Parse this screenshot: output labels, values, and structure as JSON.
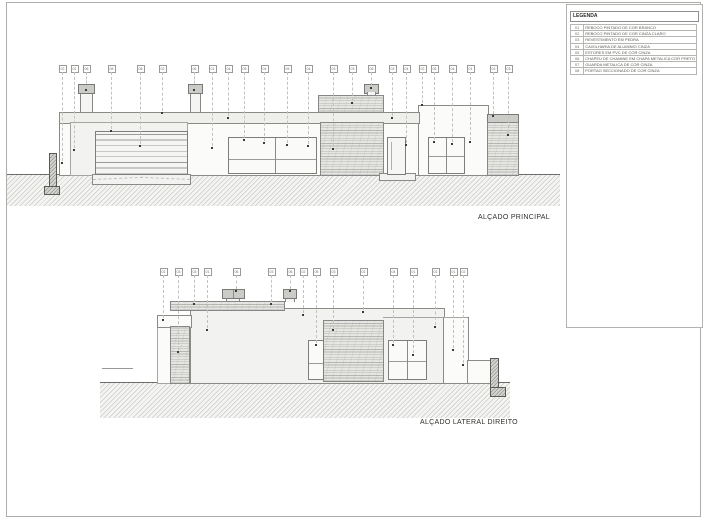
{
  "sheet": {
    "legend": {
      "title": "LEGENDA",
      "items": [
        {
          "code": "01",
          "desc": "REBOCO PINTADO DE COR BRANCO"
        },
        {
          "code": "02",
          "desc": "REBOCO PINTADO DE COR CINZA CLARO"
        },
        {
          "code": "03",
          "desc": "REVESTIMENTO EM PEDRA"
        },
        {
          "code": "04",
          "desc": "CAIXILHARIA DE ALUMINIO CINZA"
        },
        {
          "code": "05",
          "desc": "ESTORES EM PVC DE COR CINZA"
        },
        {
          "code": "06",
          "desc": "CHAPEU DE CHAMINE EM CHAPA METALICA COR PRETO"
        },
        {
          "code": "07",
          "desc": "GUARDA METALICA DE COR CINZA"
        },
        {
          "code": "08",
          "desc": "PORTAO SECCIONADO DE COR CINZA"
        }
      ]
    },
    "colors": {
      "line": "#8a8a87",
      "ground_hatch": "#c9c9c6",
      "stone": "#e6e6e3",
      "wall_light": "#f2f2f0",
      "cap_gray": "#cbcbc8"
    },
    "elevations": {
      "top": {
        "label": "ALÇADO PRINCIPAL",
        "callout_box_y": 65,
        "callouts": [
          {
            "n": "02",
            "x": 62,
            "y2": 163
          },
          {
            "n": "01",
            "x": 74,
            "y2": 150
          },
          {
            "n": "06",
            "x": 86,
            "y2": 90
          },
          {
            "n": "08",
            "x": 111,
            "y2": 131
          },
          {
            "n": "08",
            "x": 140,
            "y2": 146
          },
          {
            "n": "02",
            "x": 162,
            "y2": 113
          },
          {
            "n": "06",
            "x": 194,
            "y2": 90
          },
          {
            "n": "01",
            "x": 212,
            "y2": 148
          },
          {
            "n": "04",
            "x": 228,
            "y2": 118
          },
          {
            "n": "05",
            "x": 244,
            "y2": 140
          },
          {
            "n": "04",
            "x": 264,
            "y2": 143
          },
          {
            "n": "05",
            "x": 287,
            "y2": 145
          },
          {
            "n": "04",
            "x": 308,
            "y2": 146
          },
          {
            "n": "03",
            "x": 333,
            "y2": 149
          },
          {
            "n": "03",
            "x": 352,
            "y2": 103
          },
          {
            "n": "06",
            "x": 371,
            "y2": 88
          },
          {
            "n": "02",
            "x": 392,
            "y2": 118
          },
          {
            "n": "04",
            "x": 406,
            "y2": 145
          },
          {
            "n": "02",
            "x": 422,
            "y2": 105
          },
          {
            "n": "05",
            "x": 434,
            "y2": 142
          },
          {
            "n": "04",
            "x": 452,
            "y2": 144
          },
          {
            "n": "01",
            "x": 470,
            "y2": 142
          },
          {
            "n": "02",
            "x": 493,
            "y2": 116
          },
          {
            "n": "03",
            "x": 508,
            "y2": 135
          }
        ]
      },
      "bottom": {
        "label": "ALÇADO LATERAL DIREITO",
        "callout_box_y": 268,
        "callouts": [
          {
            "n": "02",
            "x": 163,
            "y2": 320
          },
          {
            "n": "03",
            "x": 178,
            "y2": 352
          },
          {
            "n": "03",
            "x": 194,
            "y2": 304
          },
          {
            "n": "01",
            "x": 207,
            "y2": 330
          },
          {
            "n": "06",
            "x": 236,
            "y2": 291
          },
          {
            "n": "03",
            "x": 271,
            "y2": 304
          },
          {
            "n": "06",
            "x": 290,
            "y2": 291
          },
          {
            "n": "02",
            "x": 303,
            "y2": 315
          },
          {
            "n": "05",
            "x": 316,
            "y2": 345
          },
          {
            "n": "03",
            "x": 333,
            "y2": 330
          },
          {
            "n": "02",
            "x": 363,
            "y2": 312
          },
          {
            "n": "04",
            "x": 393,
            "y2": 345
          },
          {
            "n": "01",
            "x": 413,
            "y2": 355
          },
          {
            "n": "02",
            "x": 435,
            "y2": 327
          },
          {
            "n": "01",
            "x": 453,
            "y2": 350
          },
          {
            "n": "02",
            "x": 463,
            "y2": 365
          }
        ]
      }
    }
  }
}
